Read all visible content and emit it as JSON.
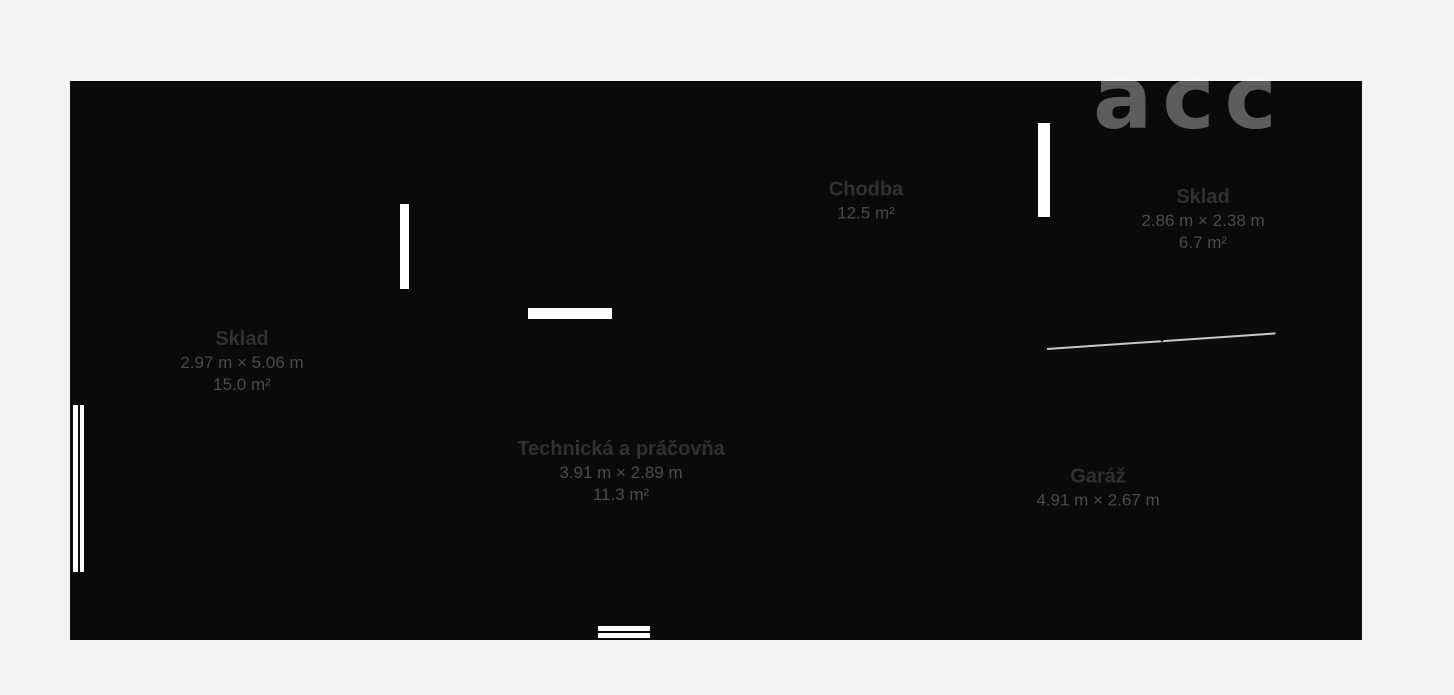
{
  "colors": {
    "background": "#f4f3f1",
    "wall": "#0a0a0a",
    "floor": "#ffffff",
    "open_door_line": "#c8c8c6",
    "room_name_text": "#313131",
    "room_detail_text": "#4c4c4c"
  },
  "watermark": {
    "text": "acc"
  },
  "rooms": [
    {
      "id": "sklad-left",
      "name": "Sklad",
      "dimensions": "2.97 m × 5.06 m",
      "area": "15.0 m²"
    },
    {
      "id": "chodba",
      "name": "Chodba",
      "dimensions": "",
      "area": "12.5 m²"
    },
    {
      "id": "sklad-right",
      "name": "Sklad",
      "dimensions": "2.86 m × 2.38 m",
      "area": "6.7 m²"
    },
    {
      "id": "technicka",
      "name": "Technická a práčovňa",
      "dimensions": "3.91 m × 2.89 m",
      "area": "11.3 m²"
    },
    {
      "id": "garaz",
      "name": "Garáž",
      "dimensions": "4.91 m × 2.67 m",
      "area": ""
    }
  ]
}
